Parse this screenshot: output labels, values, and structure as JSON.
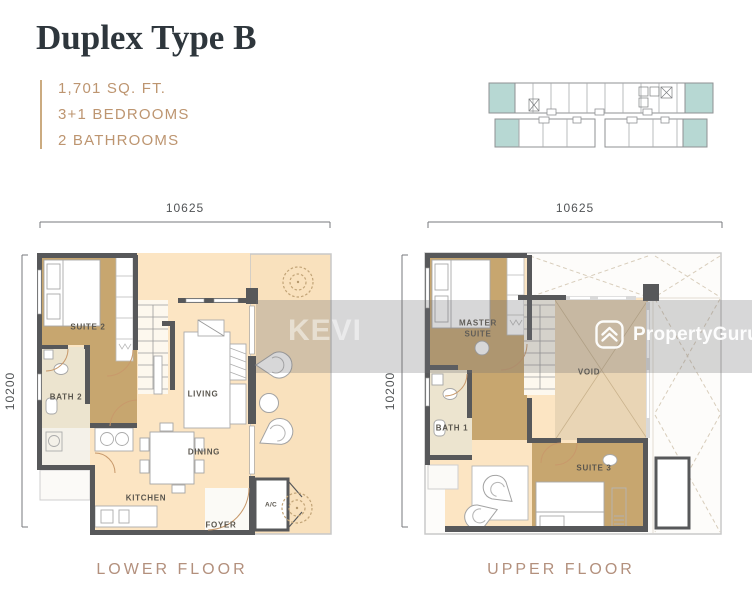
{
  "header": {
    "title": "Duplex Type B",
    "stats": [
      "1,701 SQ. FT.",
      "3+1 BEDROOMS",
      "2 BATHROOMS"
    ]
  },
  "floors": {
    "lower": {
      "caption": "LOWER FLOOR",
      "width_dim": "10625",
      "height_dim": "10200",
      "rooms": {
        "suite2": "SUITE 2",
        "bath2": "BATH 2",
        "living": "LIVING",
        "dining": "DINING",
        "kitchen": "KITCHEN",
        "foyer": "FOYER",
        "ac": "A/C"
      }
    },
    "upper": {
      "caption": "UPPER FLOOR",
      "width_dim": "10625",
      "height_dim": "10200",
      "rooms": {
        "master_line1": "MASTER",
        "master_line2": "SUITE",
        "bath1": "BATH 1",
        "void": "VOID",
        "suite3": "SUITE 3"
      }
    }
  },
  "watermarks": {
    "agent": "KEVI",
    "brand": "PropertyGuru"
  },
  "colors": {
    "title_text": "#2e363c",
    "accent_text": "#bd9570",
    "caption_text": "#b3907d",
    "wall": "#57585a",
    "floor_peach": "#fce5c3",
    "room_tan": "#c7a66f",
    "bath_cream": "#ece4cf",
    "void_beige": "#e9d5b5",
    "keyplan_teal": "#b7d8d3"
  }
}
